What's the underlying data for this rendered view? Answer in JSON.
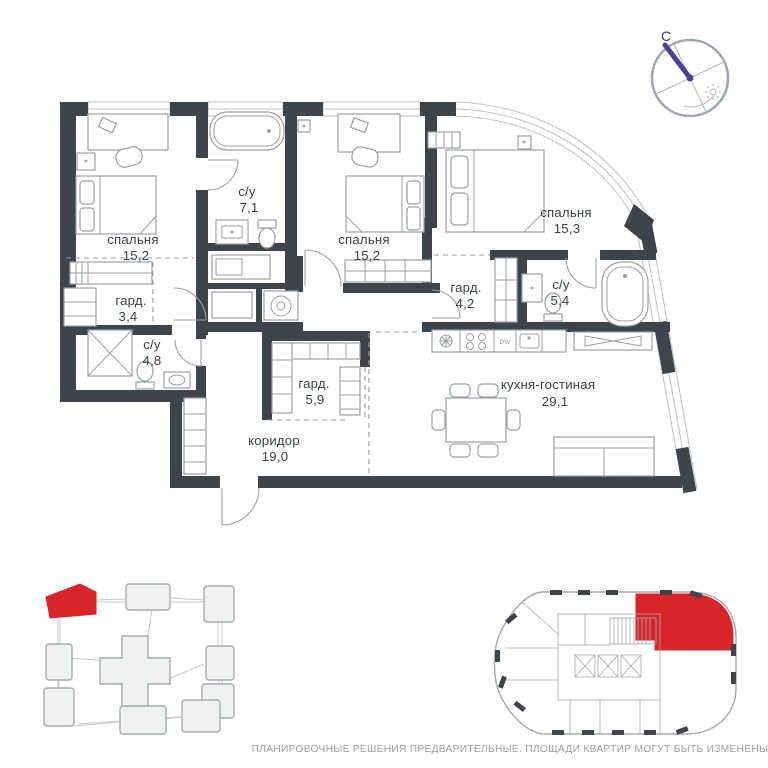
{
  "page": {
    "disclaimer": "ПЛАНИРОВОЧНЫЕ РЕШЕНИЯ ПРЕДВАРИТЕЛЬНЫЕ. ПЛОЩАДИ КВАРТИР МОГУТ БЫТЬ ИЗМЕНЕНЫ"
  },
  "compass": {
    "north_label": "С"
  },
  "colors": {
    "wall": "#3e454a",
    "line": "#9ba1a6",
    "window": "#c2c7ca",
    "accent_red": "#d8242b",
    "needle": "#4e4094",
    "label_text": "#3a4145",
    "muted_text": "#9aa0a3",
    "map_fill": "#f0f1f1",
    "map_stroke": "#a5abaf"
  },
  "rooms": [
    {
      "name": "спальня",
      "area": "15,2"
    },
    {
      "name": "с/у",
      "area": "7,1"
    },
    {
      "name": "спальня",
      "area": "15,2"
    },
    {
      "name": "спальня",
      "area": "15,3"
    },
    {
      "name": "гард.",
      "area": "3,4"
    },
    {
      "name": "с/у",
      "area": "4,8"
    },
    {
      "name": "гард.",
      "area": "4,2"
    },
    {
      "name": "с/у",
      "area": "5,4"
    },
    {
      "name": "гард.",
      "area": "5,9"
    },
    {
      "name": "коридор",
      "area": "19,0"
    },
    {
      "name": "кухня-гостиная",
      "area": "29,1"
    }
  ],
  "kitchen": {
    "dishwasher_label": "DW"
  }
}
